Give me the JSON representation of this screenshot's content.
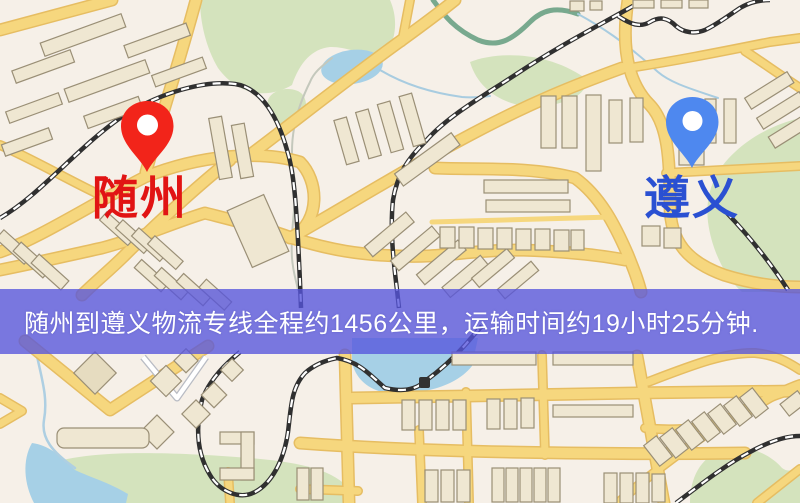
{
  "map": {
    "markers": {
      "origin": {
        "label": "随州",
        "label_color": "#e11414",
        "pin_color": "#f2241a"
      },
      "destination": {
        "label": "遵义",
        "label_color": "#2a50d2",
        "pin_color": "#4e88ef"
      }
    },
    "banner": {
      "text": "随州到遵义物流专线全程约1456公里，运输时间约19小时25分钟.",
      "distance_km": "1456",
      "duration": "19小时25分钟",
      "bg_color": "rgba(86,84,220,0.78)",
      "text_color": "#ffffff"
    },
    "palette": {
      "background": "#f6f0e8",
      "road_fill": "#f6d77e",
      "road_casing": "#e6bd62",
      "building_fill": "#efe7d2",
      "building_stroke": "#9a8f76",
      "park_green": "#d4e3bd",
      "water_blue": "#a6d0e6",
      "river_teal": "#78a98e",
      "railway_dark": "#303030"
    }
  }
}
